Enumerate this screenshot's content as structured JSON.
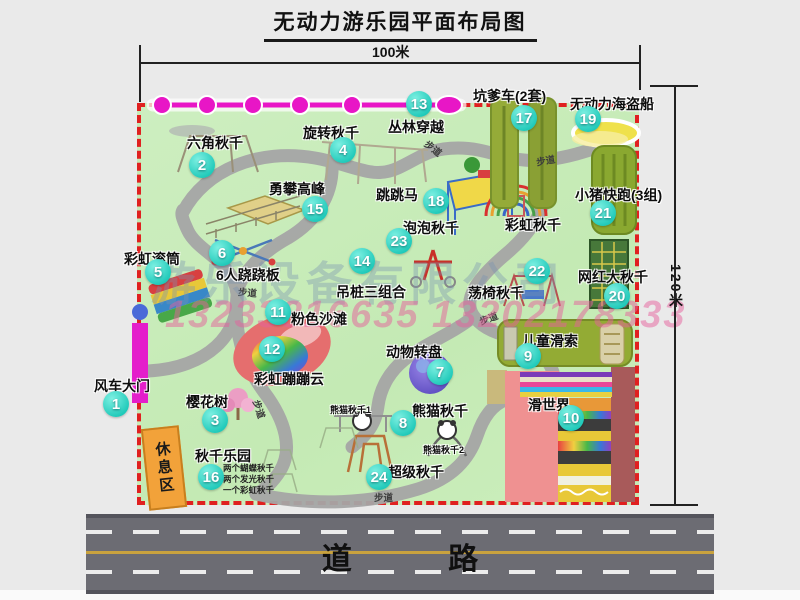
{
  "title": "无动力游乐园平面布局图",
  "dimensions": {
    "width_label": "100米",
    "height_label": "120米"
  },
  "watermark": {
    "company": "游乐设备有限公司",
    "phone": "13233816635 13202178333"
  },
  "road": {
    "label": "道 路"
  },
  "park": {
    "path_label": "步道"
  },
  "colors": {
    "park_fill": "#c9ecbb",
    "border_dashed": "#e02020",
    "badge_teal": "#2fd9c8",
    "gate_magenta": "#e41ecb",
    "zipline_magenta": "#e816c6",
    "path_gray": "#a6a6a6",
    "road_gray": "#6c6c73",
    "road_line_yellow": "#c9a23e",
    "rest_area_orange": "#f2a23a",
    "olive_box_green": "#93ab34",
    "net_box_green": "#47783a",
    "slide_pink": "#ef9191",
    "slide_dark_red": "#a85a5a",
    "pirate_ship_yellow": "#efe14b"
  },
  "items": [
    {
      "num": "1",
      "label": "风车大门"
    },
    {
      "num": "2",
      "label": "六角秋千"
    },
    {
      "num": "3",
      "label": "樱花树"
    },
    {
      "num": "4",
      "label": "旋转秋千"
    },
    {
      "num": "5",
      "label": "彩虹滚筒"
    },
    {
      "num": "6",
      "label": "6人跷跷板"
    },
    {
      "num": "7",
      "label": "动物转盘"
    },
    {
      "num": "8",
      "label": "熊猫秋千"
    },
    {
      "num": "9",
      "label": "儿童滑索"
    },
    {
      "num": "10",
      "label": "滑世界"
    },
    {
      "num": "11",
      "label": "粉色沙滩"
    },
    {
      "num": "12",
      "label": "彩虹蹦蹦云"
    },
    {
      "num": "13",
      "label": "丛林穿越"
    },
    {
      "num": "14",
      "label": "吊桩三组合"
    },
    {
      "num": "15",
      "label": "勇攀高峰"
    },
    {
      "num": "16",
      "label": "秋千乐园",
      "notes": [
        "两个蝴蝶秋千",
        "两个发光秋千",
        "一个彩虹秋千"
      ]
    },
    {
      "num": "17",
      "label": "坑爹车(2套)"
    },
    {
      "num": "18",
      "label": "跳跳马"
    },
    {
      "num": "19",
      "label": "无动力海盗船"
    },
    {
      "num": "20",
      "label": "网红大秋千"
    },
    {
      "num": "21",
      "label": "小猪快跑(3组)"
    },
    {
      "num": "22",
      "label": "荡椅秋千"
    },
    {
      "num": "23",
      "label": "泡泡秋千"
    },
    {
      "num": "24",
      "label": "超级秋千"
    }
  ],
  "extra_labels": {
    "rainbow_swing": "彩虹秋千",
    "rest_area": "休息区",
    "panda_swing_1": "熊猫秋千1",
    "panda_swing_2": "熊猫秋千2"
  }
}
